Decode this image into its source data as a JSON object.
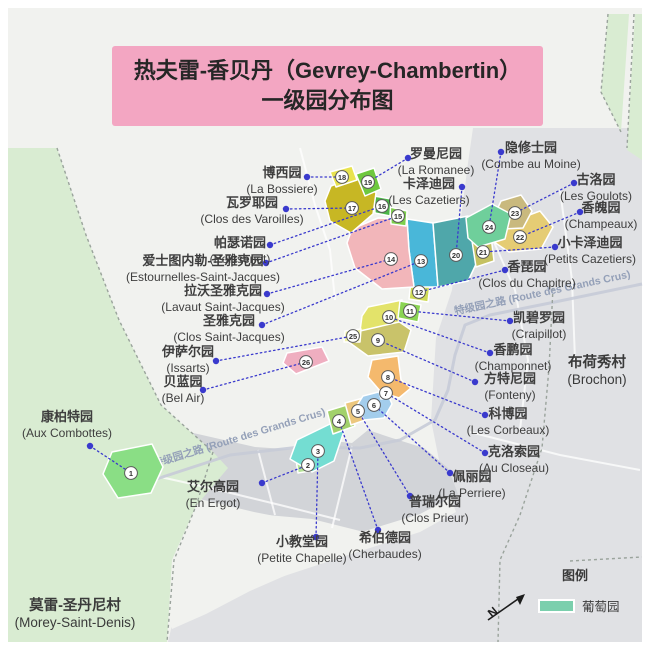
{
  "title": {
    "line1": "热夫雷-香贝丹（Gevrey-Chambertin）",
    "line2": "一级园分布图"
  },
  "colors": {
    "banner": "#f3a6c2",
    "frame_bg": "#f1f2ef",
    "leader": "#3a3acd",
    "label_text": "#3e3e3e",
    "road_text": "#94a0b8",
    "road_line": "#c6cbd7",
    "boundary": "#9aa39c",
    "marker_stroke": "#5a5a5a",
    "marker_text": "#333333",
    "village_text": "#3a3a3a",
    "legend_swatch": "#7bcfad"
  },
  "base": {
    "areas": [
      {
        "name": "bg",
        "fill": "#f1f2ef",
        "pts": "8,8 642,8 642,642 8,642"
      },
      {
        "name": "east-flatland",
        "fill": "#e0e1e4",
        "pts": "473,128 642,128 642,642 168,642 175,612 260,584 345,556 420,532 456,512 441,470 431,420 436,338 452,290 461,218 468,163"
      },
      {
        "name": "town-band",
        "fill": "#d2d4d8",
        "pts": "88,427 180,430 255,447 300,450 332,441 352,443 368,430 392,438 424,448 448,468 458,494 420,514 352,535 300,521 254,512 204,500 150,489 94,468"
      },
      {
        "name": "south-fields",
        "fill": "#f1f2ef",
        "pts": "188,507 256,514 312,519 372,534 345,551 298,570 250,591 206,614 172,629 158,570 166,524"
      },
      {
        "name": "west-green",
        "fill": "#d9ecd2",
        "pts": "8,148 57,148 86,235 119,320 161,405 213,452 228,468 196,506 172,560 167,642 8,642"
      },
      {
        "name": "ne-green-strip-1",
        "fill": "#d9ecd2",
        "pts": "608,14 629,14 621,132 601,92"
      },
      {
        "name": "ne-green-strip-2",
        "fill": "#d9ecd2",
        "pts": "635,14 642,14 642,160 627,150"
      }
    ],
    "road_line": "135,486 230,455 300,447 360,448 400,440 435,420 448,390 455,355 465,325 490,315 550,303 642,284",
    "streets": [
      "120,468 210,488 280,505 340,520",
      "258,450 275,515",
      "352,446 332,528",
      "300,148 315,205 330,250 335,300",
      "480,210 515,290 528,360 520,430",
      "560,190 572,280 575,360",
      "470,432 560,455 640,470"
    ],
    "boundaries": [
      "57,148 86,235 119,320 161,405 213,452",
      "213,452 196,506 174,560 167,642",
      "608,14 601,92 621,132",
      "634,14 627,148",
      "553,288 549,368 542,448 520,515 500,560 498,642",
      "570,561 642,557"
    ]
  },
  "roads": [
    {
      "text": "特级园之路 (Route des Grands Crus)",
      "x": 240,
      "y": 441,
      "angle": -17
    },
    {
      "text": "特级园之路 (Route des Grands Crus)",
      "x": 543,
      "y": 296,
      "angle": -12
    }
  ],
  "villages": [
    {
      "cn": "布荷秀村",
      "fr": "(Brochon)",
      "x": 597,
      "y": 367
    },
    {
      "cn": "莫雷-圣丹尼村",
      "fr": "(Morey-Saint-Denis)",
      "x": 75,
      "y": 610
    }
  ],
  "legend": {
    "title": "图例",
    "item": "葡萄园",
    "north_label": "N"
  },
  "vineyards": [
    {
      "n": 1,
      "cn": "康柏特园",
      "fr": "(Aux Combottes)",
      "color": "#8ade85",
      "poly": "112,452 152,444 163,467 151,493 118,498 103,474",
      "marker": [
        131,
        473
      ],
      "dot": [
        90,
        446
      ],
      "label": [
        67,
        421
      ]
    },
    {
      "n": 2,
      "cn": "艾尔高园",
      "fr": "(En Ergot)",
      "color": "#b5e497",
      "poly": "296,459 313,455 316,470 298,473",
      "marker": [
        308,
        465
      ],
      "dot": [
        262,
        483
      ],
      "label": [
        213,
        491
      ]
    },
    {
      "n": 3,
      "cn": "小教堂园",
      "fr": "(Petite Chapelle)",
      "color": "#74ddd2",
      "poly": "297,440 330,424 344,431 334,461 312,472 290,459",
      "marker": [
        318,
        451
      ],
      "dot": [
        316,
        537
      ],
      "label": [
        302,
        546
      ]
    },
    {
      "n": 4,
      "cn": "希伯德园",
      "fr": "(Cherbaudes)",
      "color": "#a2d16b",
      "poly": "327,411 350,404 355,426 333,434",
      "marker": [
        339,
        421
      ],
      "dot": [
        378,
        530
      ],
      "label": [
        385,
        542
      ]
    },
    {
      "n": 5,
      "cn": "普瑞尔园",
      "fr": "(Clos Prieur)",
      "color": "#ecc77d",
      "poly": "345,403 367,397 371,418 351,425",
      "marker": [
        358,
        411
      ],
      "dot": [
        410,
        496
      ],
      "label": [
        435,
        506
      ]
    },
    {
      "n": 6,
      "cn": "佩丽园",
      "fr": "(La Perriere)",
      "color": "#a3cdec",
      "poly": "363,396 386,390 392,404 384,418 364,420 356,407",
      "marker": [
        374,
        405
      ],
      "dot": [
        450,
        473
      ],
      "label": [
        472,
        481
      ]
    },
    {
      "n": 7,
      "cn": "克洛索园",
      "fr": "(Au Closeau)",
      "color": "#bcd8ee",
      "poly": "378,388 393,386 395,397 381,399",
      "marker": [
        386,
        393
      ],
      "dot": [
        485,
        453
      ],
      "label": [
        514,
        456
      ]
    },
    {
      "n": 8,
      "cn": "科博园",
      "fr": "(Les Corbeaux)",
      "color": "#f4b96d",
      "poly": "372,360 398,356 401,380 411,388 399,398 381,392 368,377",
      "marker": [
        388,
        377
      ],
      "dot": [
        485,
        415
      ],
      "label": [
        508,
        418
      ]
    },
    {
      "n": 9,
      "cn": "方特尼园",
      "fr": "(Fonteny)",
      "color": "#c9c36a",
      "poly": "356,330 398,321 411,330 404,352 368,356 350,343",
      "marker": [
        378,
        340
      ],
      "dot": [
        475,
        382
      ],
      "label": [
        510,
        383
      ]
    },
    {
      "n": 10,
      "cn": "香鹏园",
      "fr": "(Champonnet)",
      "color": "#e3e36a",
      "poly": "368,307 402,300 399,322 360,331 362,316",
      "marker": [
        389,
        317
      ],
      "dot": [
        490,
        353
      ],
      "label": [
        513,
        354
      ]
    },
    {
      "n": 11,
      "cn": "凯碧罗园",
      "fr": "(Craipillot)",
      "color": "#8ad453",
      "poly": "400,301 421,305 418,322 398,318",
      "marker": [
        410,
        311
      ],
      "dot": [
        510,
        321
      ],
      "label": [
        539,
        322
      ]
    },
    {
      "n": 12,
      "cn": "香琵园",
      "fr": "(Clos du Chapitre)",
      "color": "#cfdb58",
      "poly": "411,281 430,285 428,302 409,299",
      "marker": [
        419,
        292
      ],
      "dot": [
        505,
        270
      ],
      "label": [
        527,
        271
      ]
    },
    {
      "n": 13,
      "cn": "圣雅克园",
      "fr": "(Clos Saint-Jacques)",
      "color": "#49b7d9",
      "poly": "407,219 433,223 438,287 414,287 409,250",
      "marker": [
        421,
        261
      ],
      "dot": [
        262,
        325
      ],
      "label": [
        229,
        325
      ]
    },
    {
      "n": 14,
      "cn": "拉沃圣雅克园",
      "fr": "(Lavaut Saint-Jacques)",
      "color": "#f2b6ba",
      "poly": "352,229 378,218 407,219 409,250 414,287 382,289 355,268 347,243",
      "marker": [
        391,
        259
      ],
      "dot": [
        267,
        294
      ],
      "label": [
        223,
        295
      ]
    },
    {
      "n": 15,
      "cn": "爱士图内勒-圣雅克园",
      "fr": "(Estournelles-Saint-Jacques)",
      "color": "#7ed04c",
      "poly": "390,207 407,211 406,226 391,224",
      "marker": [
        398,
        216
      ],
      "dot": [
        266,
        263
      ],
      "label": [
        203,
        265
      ]
    },
    {
      "n": 16,
      "cn": "帕瑟诺园",
      "fr": "(Poissenot)",
      "color": "#4cb648",
      "poly": "374,196 391,199 390,216 375,213",
      "marker": [
        382,
        206
      ],
      "dot": [
        270,
        245
      ],
      "label": [
        240,
        247
      ]
    },
    {
      "n": 17,
      "cn": "瓦罗耶园",
      "fr": "(Clos des Varoilles)",
      "color": "#c7b724",
      "poly": "331,186 357,176 376,193 373,214 351,233 330,221 325,201",
      "marker": [
        352,
        208
      ],
      "dot": [
        286,
        209
      ],
      "label": [
        252,
        207
      ]
    },
    {
      "n": 18,
      "cn": "博西园",
      "fr": "(La Bossiere)",
      "color": "#e8e34f",
      "poly": "330,172 352,166 357,180 336,187",
      "marker": [
        342,
        177
      ],
      "dot": [
        307,
        177
      ],
      "label": [
        282,
        177
      ]
    },
    {
      "n": 19,
      "cn": "罗曼尼园",
      "fr": "(La Romanee)",
      "color": "#6ec83e",
      "poly": "356,174 374,168 381,189 365,196",
      "marker": [
        368,
        182
      ],
      "dot": [
        408,
        158
      ],
      "label": [
        436,
        158
      ]
    },
    {
      "n": 20,
      "cn": "卡泽迪园",
      "fr": "(Les Cazetiers)",
      "color": "#4fa7aa",
      "poly": "433,223 468,216 478,260 468,281 438,287",
      "marker": [
        456,
        255
      ],
      "dot": [
        462,
        187
      ],
      "label": [
        429,
        188
      ]
    },
    {
      "n": 21,
      "cn": "小卡泽迪园",
      "fr": "(Petits Cazetiers)",
      "color": "#c5c161",
      "poly": "472,241 491,236 494,261 476,267",
      "marker": [
        483,
        252
      ],
      "dot": [
        555,
        247
      ],
      "label": [
        590,
        247
      ]
    },
    {
      "n": 22,
      "cn": "香魄园",
      "fr": "(Champeaux)",
      "color": "#e5cc74",
      "poly": "497,227 540,211 553,227 541,249 509,252 494,242",
      "marker": [
        520,
        237
      ],
      "dot": [
        580,
        212
      ],
      "label": [
        601,
        212
      ]
    },
    {
      "n": 23,
      "cn": "古洛园",
      "fr": "(Les Goulots)",
      "color": "#c9b97e",
      "poly": "501,201 521,195 532,211 523,228 504,229 495,214",
      "marker": [
        515,
        213
      ],
      "dot": [
        574,
        183
      ],
      "label": [
        596,
        184
      ]
    },
    {
      "n": 24,
      "cn": "隐修士园",
      "fr": "(Combe au Moine)",
      "color": "#6fcf9b",
      "poly": "466,218 492,204 511,214 505,239 478,247 468,238",
      "marker": [
        489,
        227
      ],
      "dot": [
        501,
        152
      ],
      "label": [
        531,
        152
      ]
    },
    {
      "n": 25,
      "cn": "伊萨尔园",
      "fr": "(Issarts)",
      "color": "#eff0a2",
      "poly": "345,331 361,329 360,342 344,342",
      "marker": [
        353,
        336
      ],
      "dot": [
        216,
        361
      ],
      "label": [
        188,
        356
      ]
    },
    {
      "n": 26,
      "cn": "贝蓝园",
      "fr": "(Bel Air)",
      "color": "#efaec0",
      "poly": "287,353 322,347 329,361 296,374 283,363",
      "marker": [
        306,
        362
      ],
      "dot": [
        203,
        390
      ],
      "label": [
        183,
        386
      ]
    }
  ]
}
